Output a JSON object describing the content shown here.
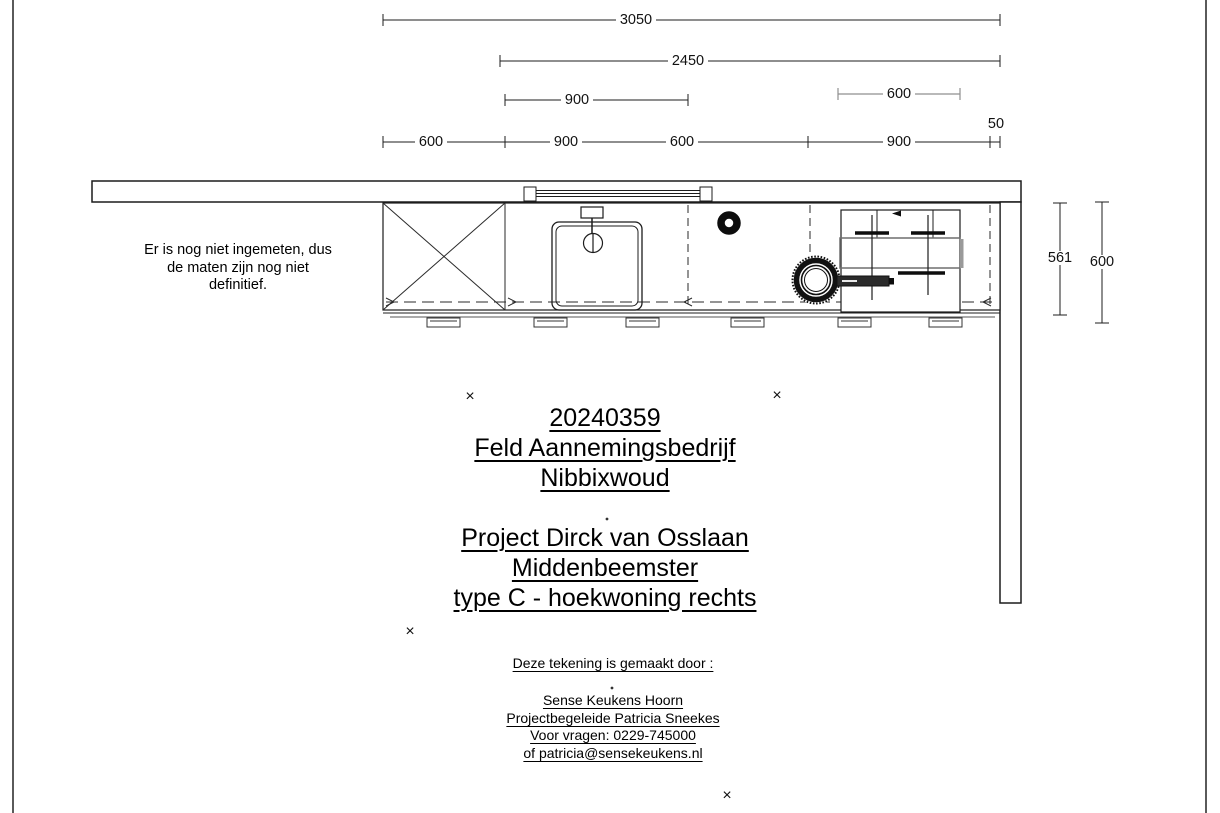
{
  "note": {
    "line1": "Er is nog niet ingemeten, dus",
    "line2": "de maten zijn nog niet",
    "line3": "definitief."
  },
  "title_block": {
    "project_number": "20240359",
    "client": "Feld Aannemingsbedrijf",
    "client_city": "Nibbixwoud",
    "project_name": "Project Dirck van Osslaan",
    "project_city": "Middenbeemster",
    "house_type": "type C - hoekwoning rechts"
  },
  "credits": {
    "heading": "Deze tekening is gemaakt door :",
    "company": "Sense Keukens Hoorn",
    "contact": "Projectbegeleide Patricia Sneekes",
    "phone": "Voor vragen: 0229-745000",
    "email": "of patricia@sensekeukens.nl"
  },
  "dimensions": {
    "total": "3050",
    "right_run": "2450",
    "sink_cabinet": "900",
    "hob": "600",
    "seg1": "600",
    "seg2": "900",
    "seg3": "600",
    "seg4": "900",
    "end_gap": "50",
    "counter_depth": "561",
    "total_depth": "600"
  },
  "marker": "×"
}
